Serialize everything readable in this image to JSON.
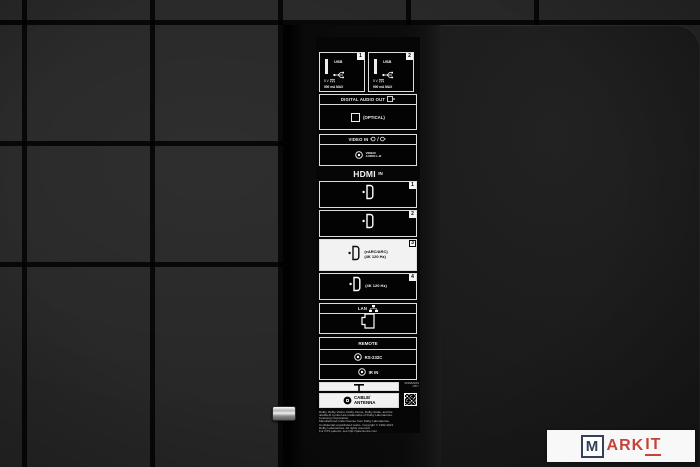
{
  "panel": {
    "usb": {
      "ports": [
        {
          "number": "1",
          "label": "USB",
          "voltage": "5 V",
          "current": "500 mA MAX"
        },
        {
          "number": "2",
          "label": "USB",
          "voltage": "5 V",
          "current": "900 mA MAX"
        }
      ]
    },
    "digital_audio_out": {
      "header": "DIGITAL AUDIO OUT",
      "port_label": "(OPTICAL)"
    },
    "video_in": {
      "header": "VIDEO IN",
      "port_line1": "VIDEO/",
      "port_line2": "AUDIO-L-R"
    },
    "hdmi": {
      "logo": "HDMI",
      "suffix": "IN",
      "ports": [
        {
          "number": "1",
          "line1": "",
          "line2": ""
        },
        {
          "number": "2",
          "line1": "",
          "line2": ""
        },
        {
          "number": "3",
          "line1": "(eARC/ARC)",
          "line2": "(4K 120 Hz)"
        },
        {
          "number": "4",
          "line1": "(4K 120 Hz)",
          "line2": ""
        }
      ]
    },
    "lan": {
      "header": "LAN"
    },
    "remote": {
      "header": "REMOTE",
      "rows": [
        {
          "label": "RS-232C"
        },
        {
          "label": "IR IN"
        }
      ]
    },
    "cable_antenna": {
      "line1": "CABLE/",
      "line2": "ANTENNA"
    },
    "serial_number": "S0396A601",
    "recycling_mark": ">PP<",
    "legal_lines": [
      "Dolby, Dolby Vision, Dolby Atmos, Dolby Audio, and the",
      "double-D symbol are trademarks of Dolby Laboratories.",
      "Licensing Corporation.",
      "Manufactured under license from Dolby Laboratories.",
      "Confidential unpublished works. Copyright © 1992-2021",
      "Dolby Laboratories. All rights reserved.",
      "For DTS patents, see http://patents.dts.com."
    ]
  },
  "watermark": {
    "m": "M",
    "ark": "ARK",
    "it": "IT"
  },
  "colors": {
    "tile": "#272727",
    "panel": "#1a1a1a",
    "strip_bg": "#060606",
    "box_border": "#dedede",
    "highlight_box": "#f2f2f2",
    "watermark_navy": "#33415c",
    "watermark_red": "#c4443c"
  }
}
